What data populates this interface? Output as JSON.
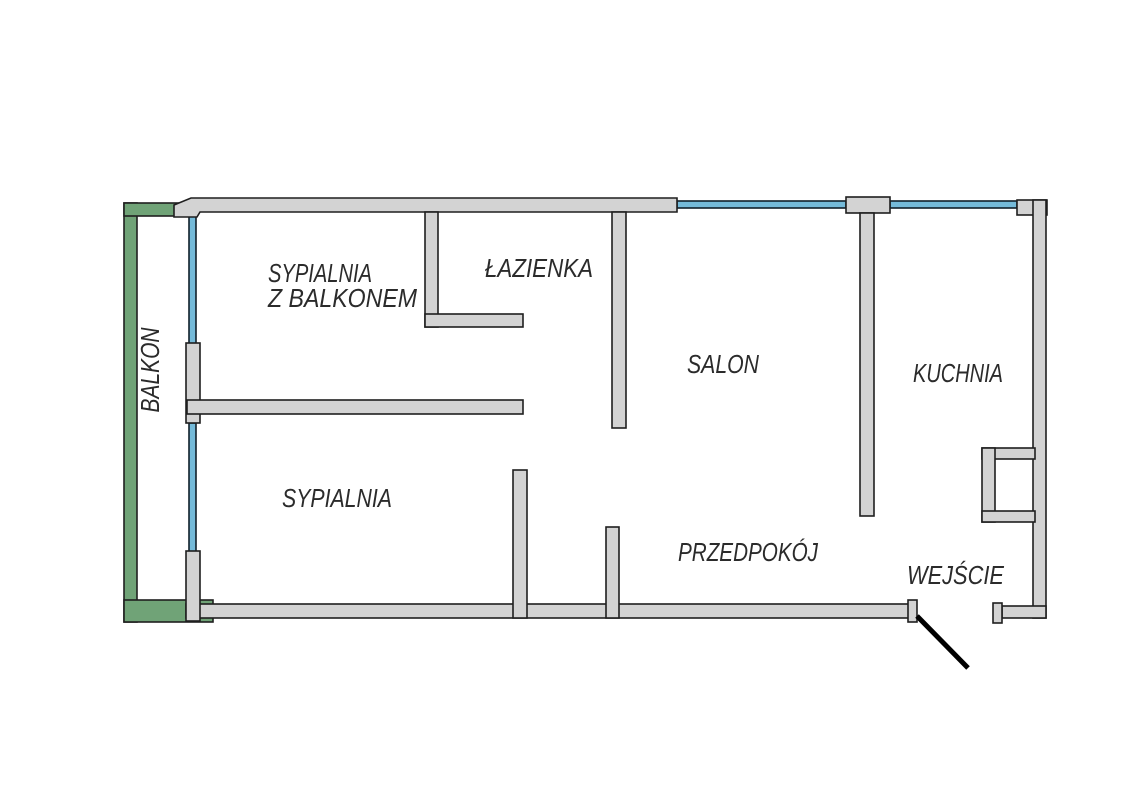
{
  "meta": {
    "title": "Apartment floor plan",
    "language": "pl",
    "background": "#ffffff"
  },
  "style": {
    "wall_fill": "#d3d3d3",
    "wall_stroke": "#1f1f1f",
    "wall_stroke_width": 1.6,
    "balcony_fill": "#70a377",
    "balcony_stroke": "#1f1f1f",
    "window_fill": "#74bad9",
    "window_stroke": "#10202a",
    "door_color": "#000000",
    "door_stroke_width": 5,
    "label_color": "#2b2b2b",
    "label_font_size": 26
  },
  "rooms": [
    {
      "id": "balkon",
      "label": "BALKON",
      "x": 159,
      "y": 370,
      "rotate": -90,
      "length": 85
    },
    {
      "id": "sypialnia-z-balkonem",
      "label": "SYPIALNIA",
      "x": 268,
      "y": 282,
      "length": 104
    },
    {
      "id": "sypialnia-z-balkonem-line2",
      "label": "Z BALKONEM",
      "x": 268,
      "y": 307,
      "length": 149
    },
    {
      "id": "lazienka",
      "label": "ŁAZIENKA",
      "x": 485,
      "y": 277,
      "length": 108
    },
    {
      "id": "salon",
      "label": "SALON",
      "x": 687,
      "y": 373,
      "length": 72
    },
    {
      "id": "kuchnia",
      "label": "KUCHNIA",
      "x": 913,
      "y": 382,
      "length": 90
    },
    {
      "id": "sypialnia",
      "label": "SYPIALNIA",
      "x": 282,
      "y": 507,
      "length": 110
    },
    {
      "id": "przedpokoj",
      "label": "PRZEDPOKÓJ",
      "x": 678,
      "y": 561,
      "length": 140
    },
    {
      "id": "wejscie",
      "label": "WEJŚCIE",
      "x": 907,
      "y": 584,
      "length": 97
    }
  ],
  "plan": {
    "canvas": {
      "width": 1123,
      "height": 794
    },
    "elements": [
      {
        "kind": "balcony-wall",
        "name": "balcony-wall-left",
        "x": 124,
        "y": 203,
        "w": 13,
        "h": 419
      },
      {
        "kind": "balcony-wall",
        "name": "balcony-wall-top",
        "x": 124,
        "y": 203,
        "w": 56,
        "h": 13
      },
      {
        "kind": "balcony-wall",
        "name": "balcony-wall-bottom",
        "x": 124,
        "y": 600,
        "w": 89,
        "h": 22
      },
      {
        "kind": "window",
        "name": "window-bedroom-balcony-upper",
        "x": 189,
        "y": 215,
        "w": 7,
        "h": 129
      },
      {
        "kind": "window",
        "name": "window-bedroom-balcony-lower",
        "x": 189,
        "y": 423,
        "w": 7,
        "h": 129
      },
      {
        "kind": "window",
        "name": "window-salon",
        "x": 677,
        "y": 201,
        "w": 169,
        "h": 7
      },
      {
        "kind": "window",
        "name": "window-kitchen",
        "x": 890,
        "y": 201,
        "w": 127,
        "h": 7
      },
      {
        "kind": "wall-poly",
        "name": "wall-exterior-top",
        "points": "174,205 191,198 677,198 677,212 200,212 197,217 174,217"
      },
      {
        "kind": "wall",
        "name": "wall-top-cap-between-windows",
        "x": 846,
        "y": 197,
        "w": 44,
        "h": 16
      },
      {
        "kind": "wall",
        "name": "wall-corner-top-right",
        "x": 1017,
        "y": 200,
        "w": 30,
        "h": 15
      },
      {
        "kind": "wall",
        "name": "wall-exterior-right",
        "x": 1033,
        "y": 200,
        "w": 13,
        "h": 418
      },
      {
        "kind": "wall",
        "name": "wall-shaft-top",
        "x": 982,
        "y": 448,
        "w": 53,
        "h": 11
      },
      {
        "kind": "wall",
        "name": "wall-shaft-left",
        "x": 982,
        "y": 448,
        "w": 13,
        "h": 74
      },
      {
        "kind": "wall",
        "name": "wall-shaft-bottom",
        "x": 982,
        "y": 511,
        "w": 53,
        "h": 11
      },
      {
        "kind": "wall",
        "name": "wall-entry-right",
        "x": 1002,
        "y": 606,
        "w": 44,
        "h": 12
      },
      {
        "kind": "wall",
        "name": "door-jamb-entry-right",
        "x": 993,
        "y": 603,
        "w": 9,
        "h": 20
      },
      {
        "kind": "wall",
        "name": "wall-exterior-bottom",
        "x": 186,
        "y": 604,
        "w": 724,
        "h": 14
      },
      {
        "kind": "wall",
        "name": "door-jamb-entry-left",
        "x": 908,
        "y": 600,
        "w": 9,
        "h": 22
      },
      {
        "kind": "wall",
        "name": "wall-balcony-pier-lower",
        "x": 186,
        "y": 551,
        "w": 14,
        "h": 70
      },
      {
        "kind": "wall",
        "name": "wall-balcony-pier-mid",
        "x": 186,
        "y": 343,
        "w": 14,
        "h": 80
      },
      {
        "kind": "wall",
        "name": "wall-bedroom-divider",
        "x": 187,
        "y": 400,
        "w": 336,
        "h": 14
      },
      {
        "kind": "wall",
        "name": "wall-bathroom-left",
        "x": 425,
        "y": 212,
        "w": 13,
        "h": 115
      },
      {
        "kind": "wall",
        "name": "wall-bathroom-bottom",
        "x": 425,
        "y": 314,
        "w": 98,
        "h": 13
      },
      {
        "kind": "wall",
        "name": "wall-bathroom-right",
        "x": 612,
        "y": 212,
        "w": 14,
        "h": 216
      },
      {
        "kind": "wall",
        "name": "wall-salon-kitchen",
        "x": 860,
        "y": 213,
        "w": 14,
        "h": 303
      },
      {
        "kind": "wall",
        "name": "wall-hall-stub-left",
        "x": 513,
        "y": 470,
        "w": 14,
        "h": 148
      },
      {
        "kind": "wall",
        "name": "wall-hall-stub-right",
        "x": 606,
        "y": 527,
        "w": 13,
        "h": 91
      },
      {
        "kind": "door-swing",
        "name": "entry-door-swing",
        "x1": 917,
        "y1": 616,
        "x2": 968,
        "y2": 668
      }
    ]
  }
}
